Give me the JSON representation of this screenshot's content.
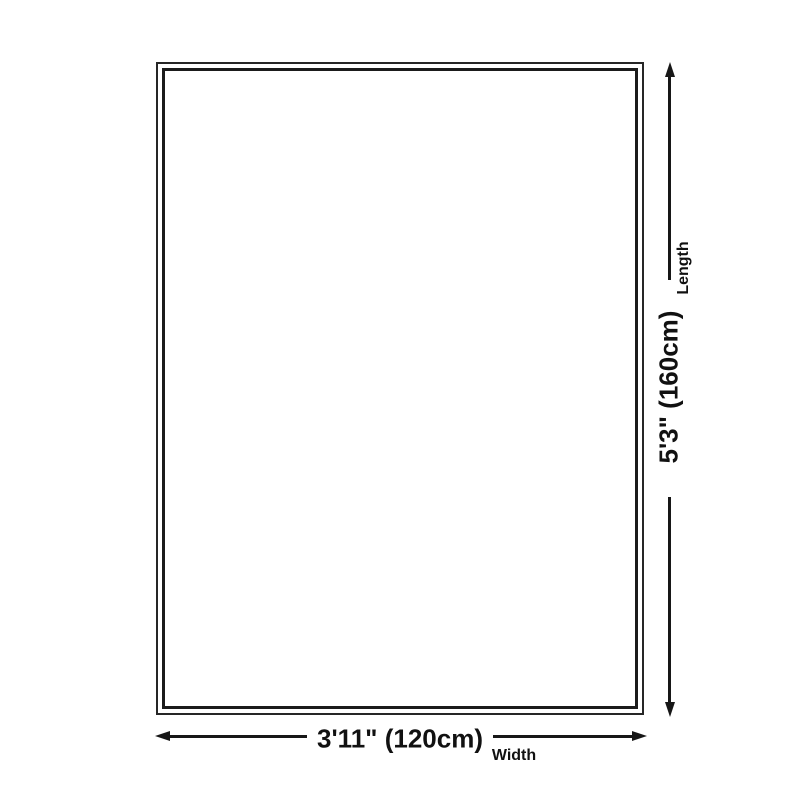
{
  "diagram": {
    "kind": "rug-size-dimension-diagram",
    "colors": {
      "background": "#ffffff",
      "ink": "#171717",
      "text": "#111111"
    },
    "length_dimension": {
      "label": "Length",
      "value": "5'3\" (160cm)",
      "arrow": "vertical-double-headed"
    },
    "width_dimension": {
      "label": "Width",
      "value": "3'11\" (120cm)",
      "arrow": "horizontal-double-headed"
    }
  }
}
